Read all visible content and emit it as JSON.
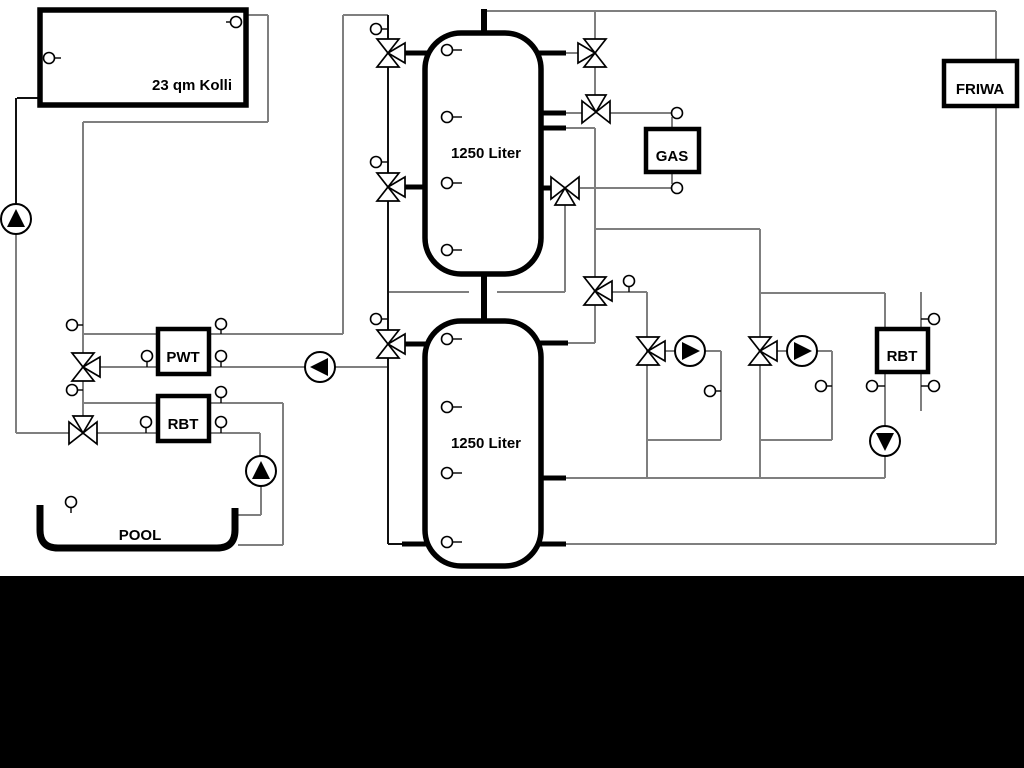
{
  "labels": {
    "collector": "23 qm Kolli",
    "tank_top": "1250 Liter",
    "tank_bottom": "1250 Liter",
    "pwt": "PWT",
    "rbt_left": "RBT",
    "gas": "GAS",
    "friwa": "FRIWA",
    "rbt_right": "RBT",
    "pool": "POOL"
  },
  "colors": {
    "background": "#ffffff",
    "letterbox_band": "#000000",
    "pipe_gray": "#7f7f7f",
    "pipe_black": "#111111"
  },
  "symbols": {
    "pump": "circle-with-filled-triangle",
    "three_way_valve": "three-triangle-valve",
    "sensor": "small-circle-with-stem"
  },
  "counts": {
    "pumps": 6,
    "three_way_valves": 11,
    "sensor_points": 30,
    "buffer_tanks": 2
  }
}
